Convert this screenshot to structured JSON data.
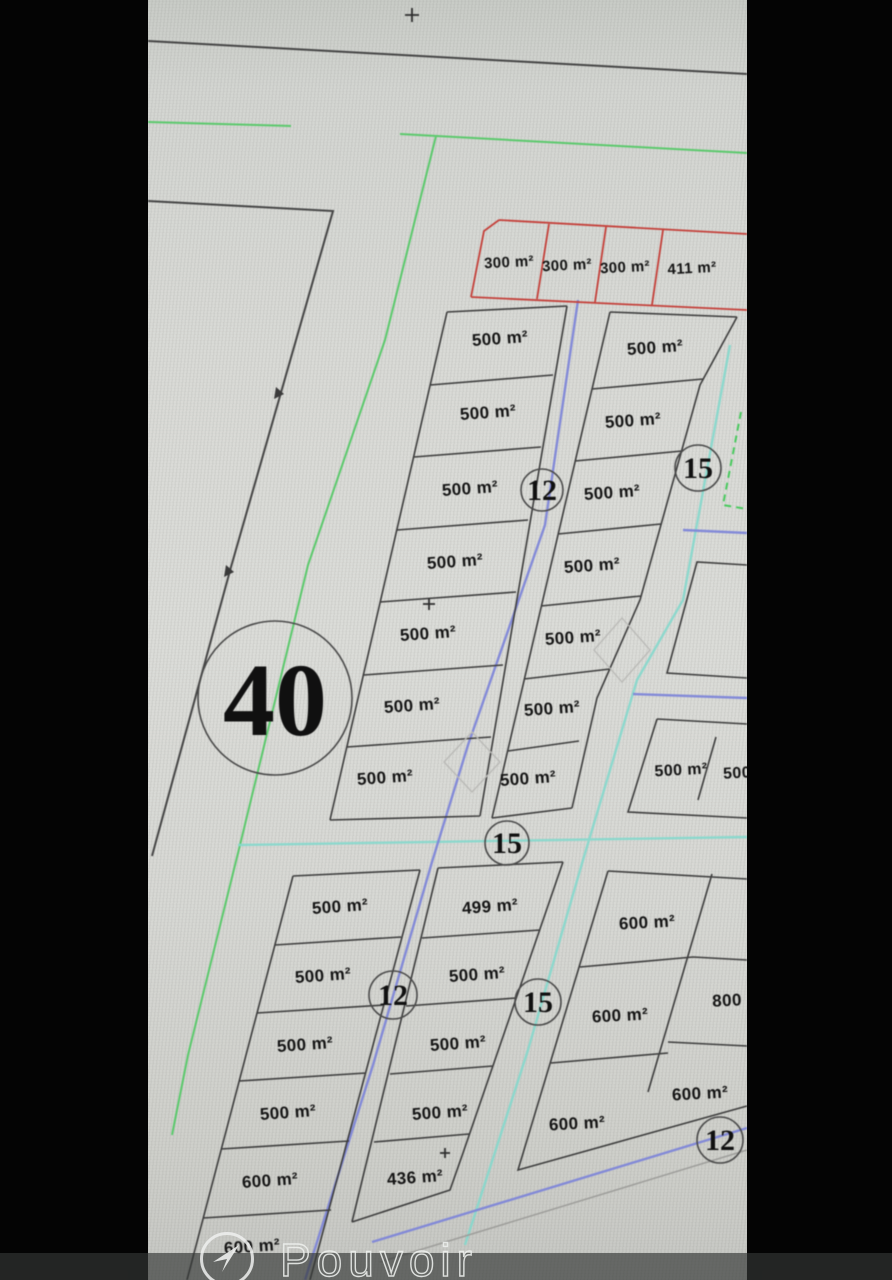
{
  "watermark": {
    "brand": "Pouvoir",
    "logo": "arrow-logo"
  },
  "plan": {
    "red": [
      "300 m²",
      "300 m²",
      "300 m²",
      "411 m²"
    ],
    "mid_left": [
      "500 m²",
      "500 m²",
      "500 m²",
      "500 m²",
      "500 m²",
      "500 m²",
      "500 m²"
    ],
    "mid_right": [
      "500 m²",
      "500 m²",
      "500 m²",
      "500 m²",
      "500 m²",
      "500 m²",
      "500 m²"
    ],
    "right_mid": [
      "500 m²",
      "500"
    ],
    "bl_col1": [
      "500 m²",
      "500 m²",
      "500 m²",
      "500 m²",
      "600 m²",
      "600 m²"
    ],
    "bl_col2": [
      "499 m²",
      "500 m²",
      "500 m²",
      "500 m²",
      "436 m²"
    ],
    "br": [
      "600 m²",
      "800",
      "600 m²",
      "600 m²",
      "600 m²"
    ],
    "circles": [
      "40",
      "12",
      "15",
      "15",
      "12",
      "15",
      "12"
    ],
    "colors": {
      "parcel_line": "#3d3d3d",
      "red_zone": "#c4403a",
      "road_blue": "#7e86d8",
      "road_teal": "#84d8cc",
      "boundary_green": "#5bc96c",
      "screen_gray": "#d8d9d5",
      "letterbox": "#040404"
    }
  }
}
